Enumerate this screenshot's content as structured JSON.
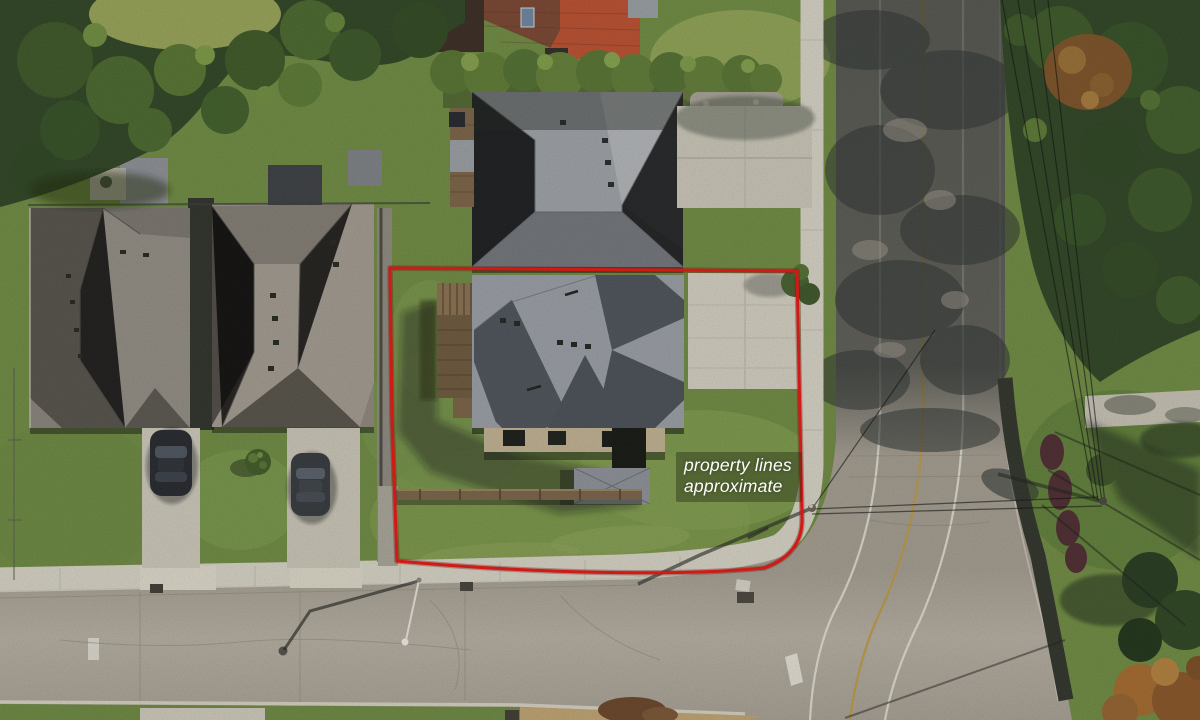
{
  "overlay": {
    "disclaimer": {
      "line1": "property lines",
      "line2": "approximate",
      "full_text": "property lines approximate",
      "text_color": "#ffffff",
      "backdrop_color": "rgba(42,52,24,0.45)"
    },
    "boundary": {
      "color": "#e8150e",
      "underlay_color": "#7e0d08"
    }
  },
  "palette": {
    "grass": "#6f8c41",
    "grass_light": "#86a050",
    "road_asphalt": "#aaa295",
    "road_shadowed": "#3c4140",
    "concrete_sidewalk": "#d9d5c7",
    "roof_light_gray": "#9ba0a7",
    "roof_dark_gray": "#4d525a",
    "roof_red": "#bd4f2e",
    "tree_canopy": "#2e4422",
    "autumn_foliage": "#9a6f33",
    "lane_line_white": "#e9e6db",
    "lane_line_yellow": "#c09a45"
  }
}
